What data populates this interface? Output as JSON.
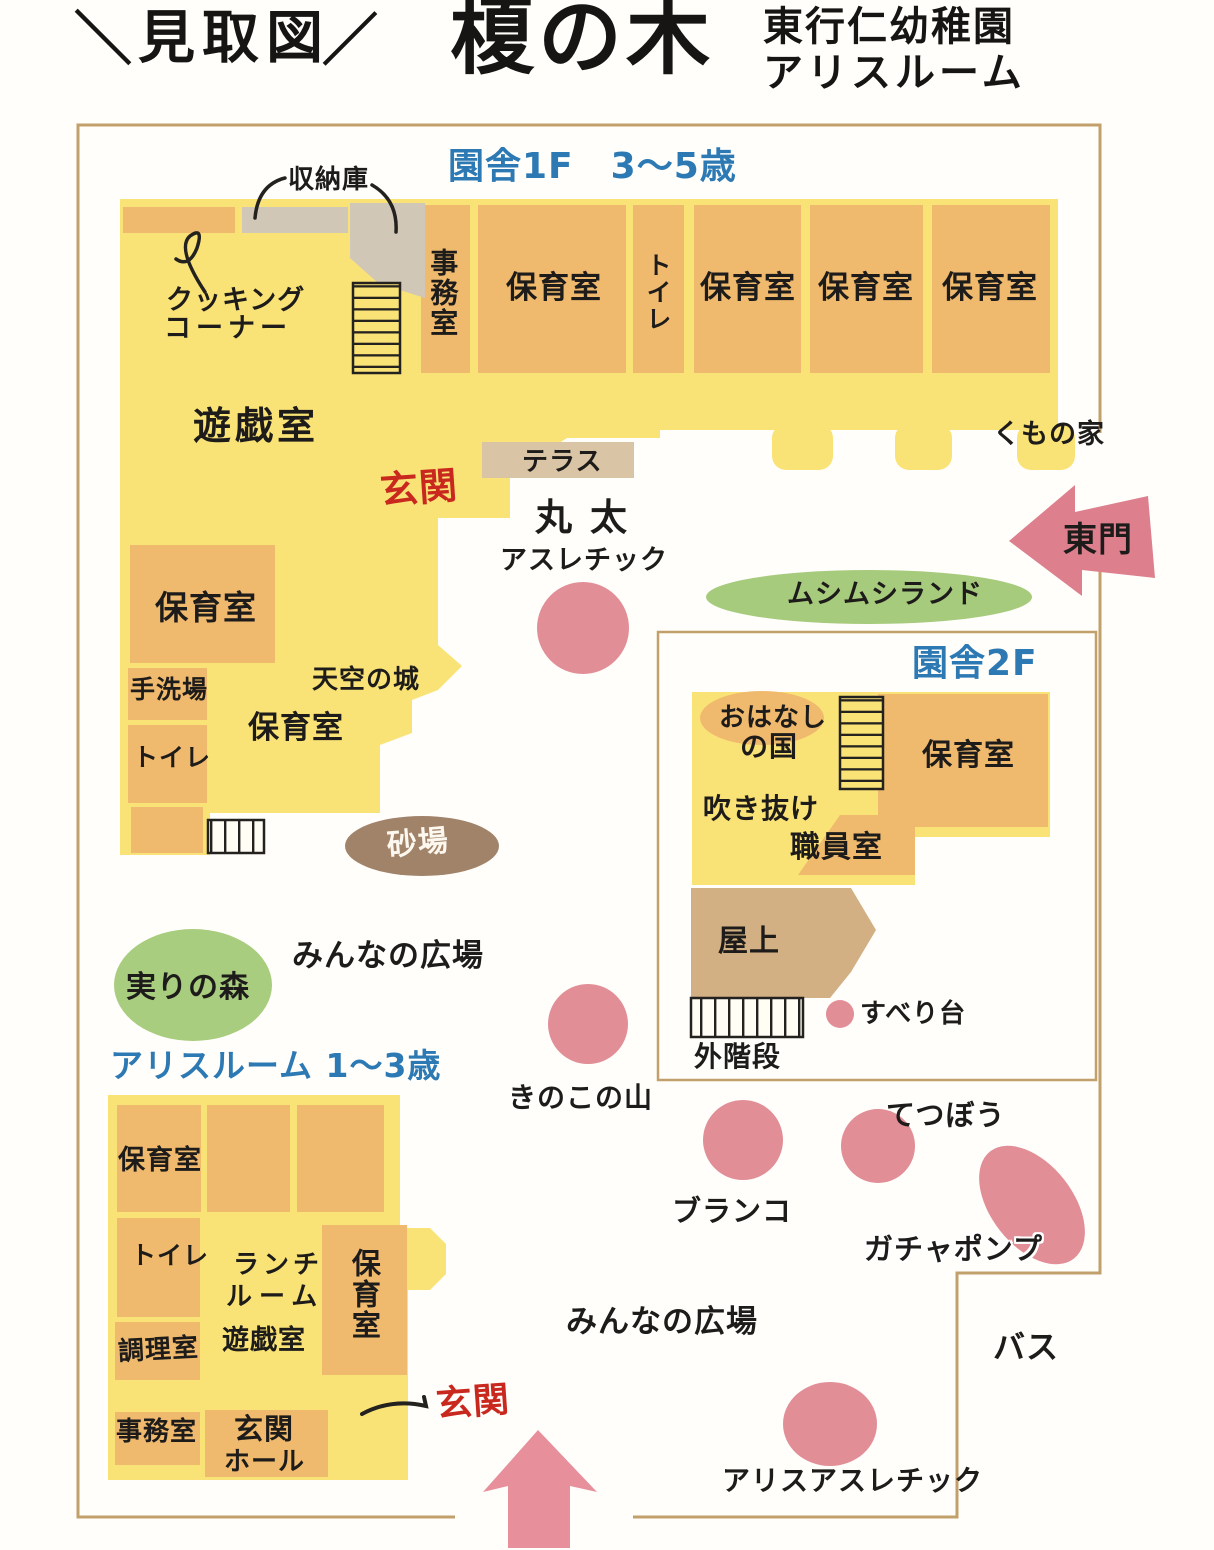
{
  "header": {
    "slash_left": "＼",
    "plan_title": "見取図",
    "slash_right": "／",
    "main_title": "榎の木",
    "school_name": "東行仁幼稚園",
    "room_name": "アリスルーム"
  },
  "colors": {
    "building_yellow": "#fae376",
    "room_orange": "#f0ba6e",
    "storage_grey": "#d0c7b6",
    "rooftop_tan": "#d2b083",
    "terrace_tan": "#d9c5a5",
    "equipment_pink": "#e28e97",
    "gate_pink": "#dd7f8d",
    "green": "#a7cb7d",
    "sand_brown": "#a1836a",
    "border_tan": "#c2a06b",
    "blue_text": "#2c79b4",
    "red_text": "#c9281e"
  },
  "building_1f": {
    "section_label": "園舎1F　3〜5歳",
    "storage": "収納庫",
    "cooking_corner": [
      "クッキング",
      "コーナー"
    ],
    "office": "事務室",
    "nursery": "保育室",
    "toilet": "トイレ",
    "playroom": "遊戯室",
    "entrance": "玄関",
    "terrace": "テラス",
    "handwash": "手洗場",
    "sky_castle": "天空の城"
  },
  "building_2f": {
    "section_label": "園舎2F",
    "story_room": [
      "おはなし",
      "の国"
    ],
    "atrium": "吹き抜け",
    "staff_room": "職員室",
    "nursery": "保育室",
    "rooftop": "屋上",
    "outdoor_stairs": "外階段",
    "slide": "すべり台"
  },
  "alice_building": {
    "section_label": "アリスルーム 1〜3歳",
    "nursery": "保育室",
    "toilet": "トイレ",
    "lunch_room": [
      "ランチ",
      "ルーム"
    ],
    "kitchen": "調理室",
    "playroom": "遊戯室",
    "office": "事務室",
    "entrance_hall": [
      "玄関",
      "ホール"
    ],
    "entrance": "玄関"
  },
  "grounds": {
    "log_athletic": [
      "丸太",
      "アスレチック"
    ],
    "mushimushi_land": "ムシムシランド",
    "east_gate": "東門",
    "spider_house": "くもの家",
    "sandbox": "砂場",
    "fruit_forest": "実りの森",
    "everyone_plaza": "みんなの広場",
    "mushroom_mountain": "きのこの山",
    "swing": "ブランコ",
    "iron_bar": "てつぼう",
    "gacha_pump": "ガチャポンプ",
    "alice_athletic": "アリスアスレチック",
    "bus": "バス"
  }
}
